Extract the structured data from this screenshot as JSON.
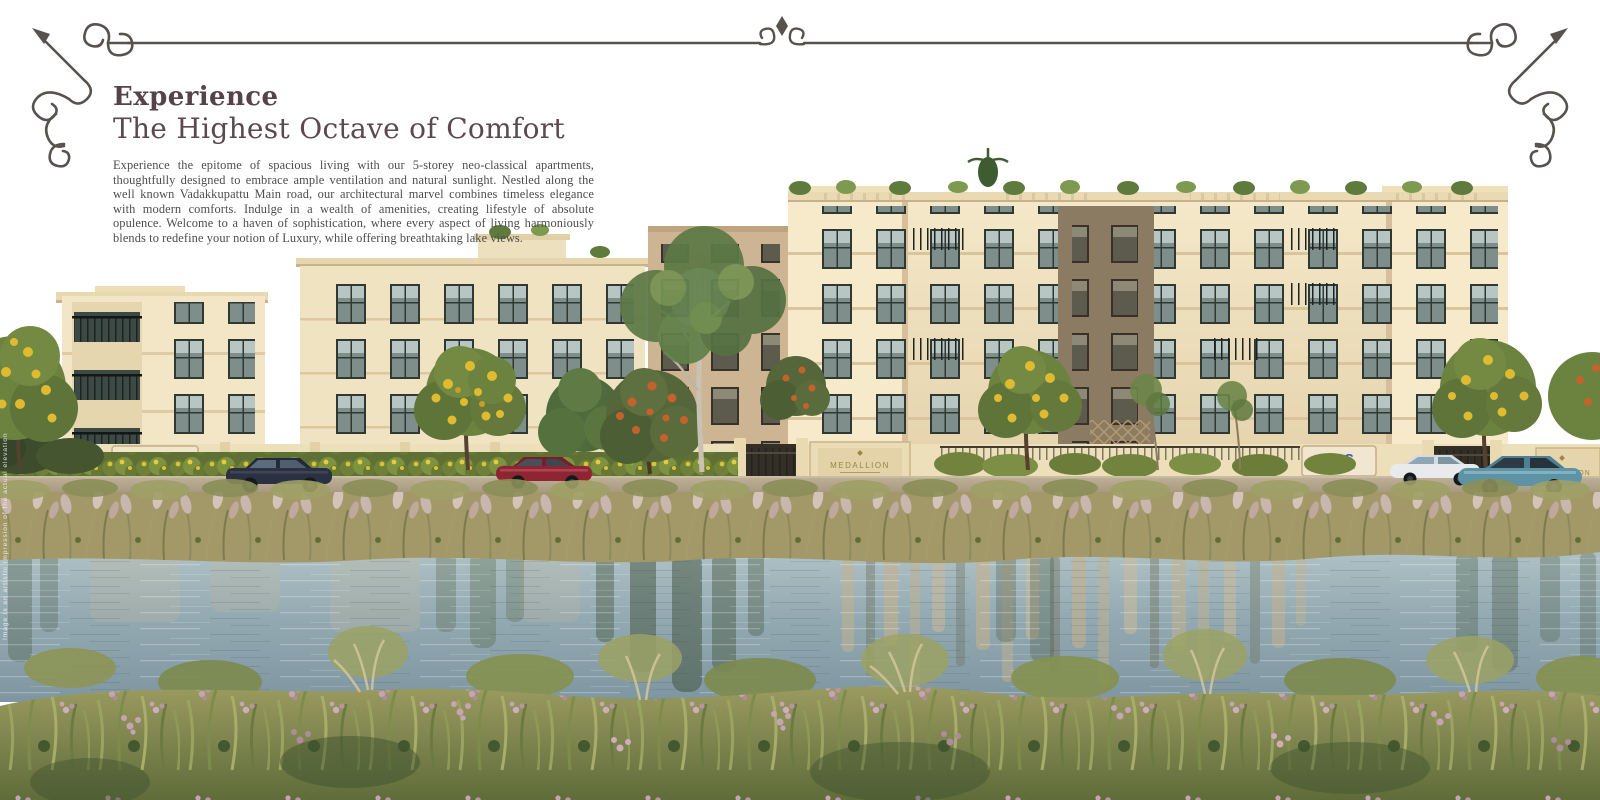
{
  "brochure": {
    "heading": {
      "line1": "Experience",
      "line2": "The Highest Octave of Comfort"
    },
    "body_paragraph": "Experience the epitome of spacious living with our 5-storey neo-classical apartments, thoughtfully designed to embrace ample ventilation and natural sunlight. Nestled along the well known Vadakkupattu Main road, our architectural marvel combines timeless elegance with modern comforts. Indulge in a wealth of amenities, creating lifestyle of absolute opulence. Welcome to a haven of sophistication, where every aspect of living harmoniously blends to redefine your notion of Luxury, while offering breathtaking lake views.",
    "side_disclaimer": "Image is an artistic impression of the actual elevation"
  },
  "scene": {
    "signs": {
      "developer": {
        "label": "DAC",
        "sub": "DEVELOPERS"
      },
      "project": {
        "label": "MEDALLION"
      }
    },
    "colors": {
      "heading_text": "#564349",
      "body_text": "#4D4D4D",
      "ornament_line": "#57524C",
      "building_cream": "#F2E6C6",
      "building_tan": "#D9C49D",
      "window_glass": "#7E8F8B",
      "sign_blue": "#3D4FC4",
      "sign_gold": "#9A8345",
      "hedge_green": "#7F9240",
      "bloom_yellow": "#E0BB30",
      "bloom_orange": "#C4622C",
      "water_blue": "#93A9B0",
      "reed_khaki": "#A39868",
      "grass_olive": "#7E8C4B",
      "flower_mauve": "#C6A4B2",
      "car_navy": "#2B3140",
      "car_red": "#8F2532",
      "car_white": "#E9EAEC",
      "car_teal": "#5E93A6"
    }
  }
}
